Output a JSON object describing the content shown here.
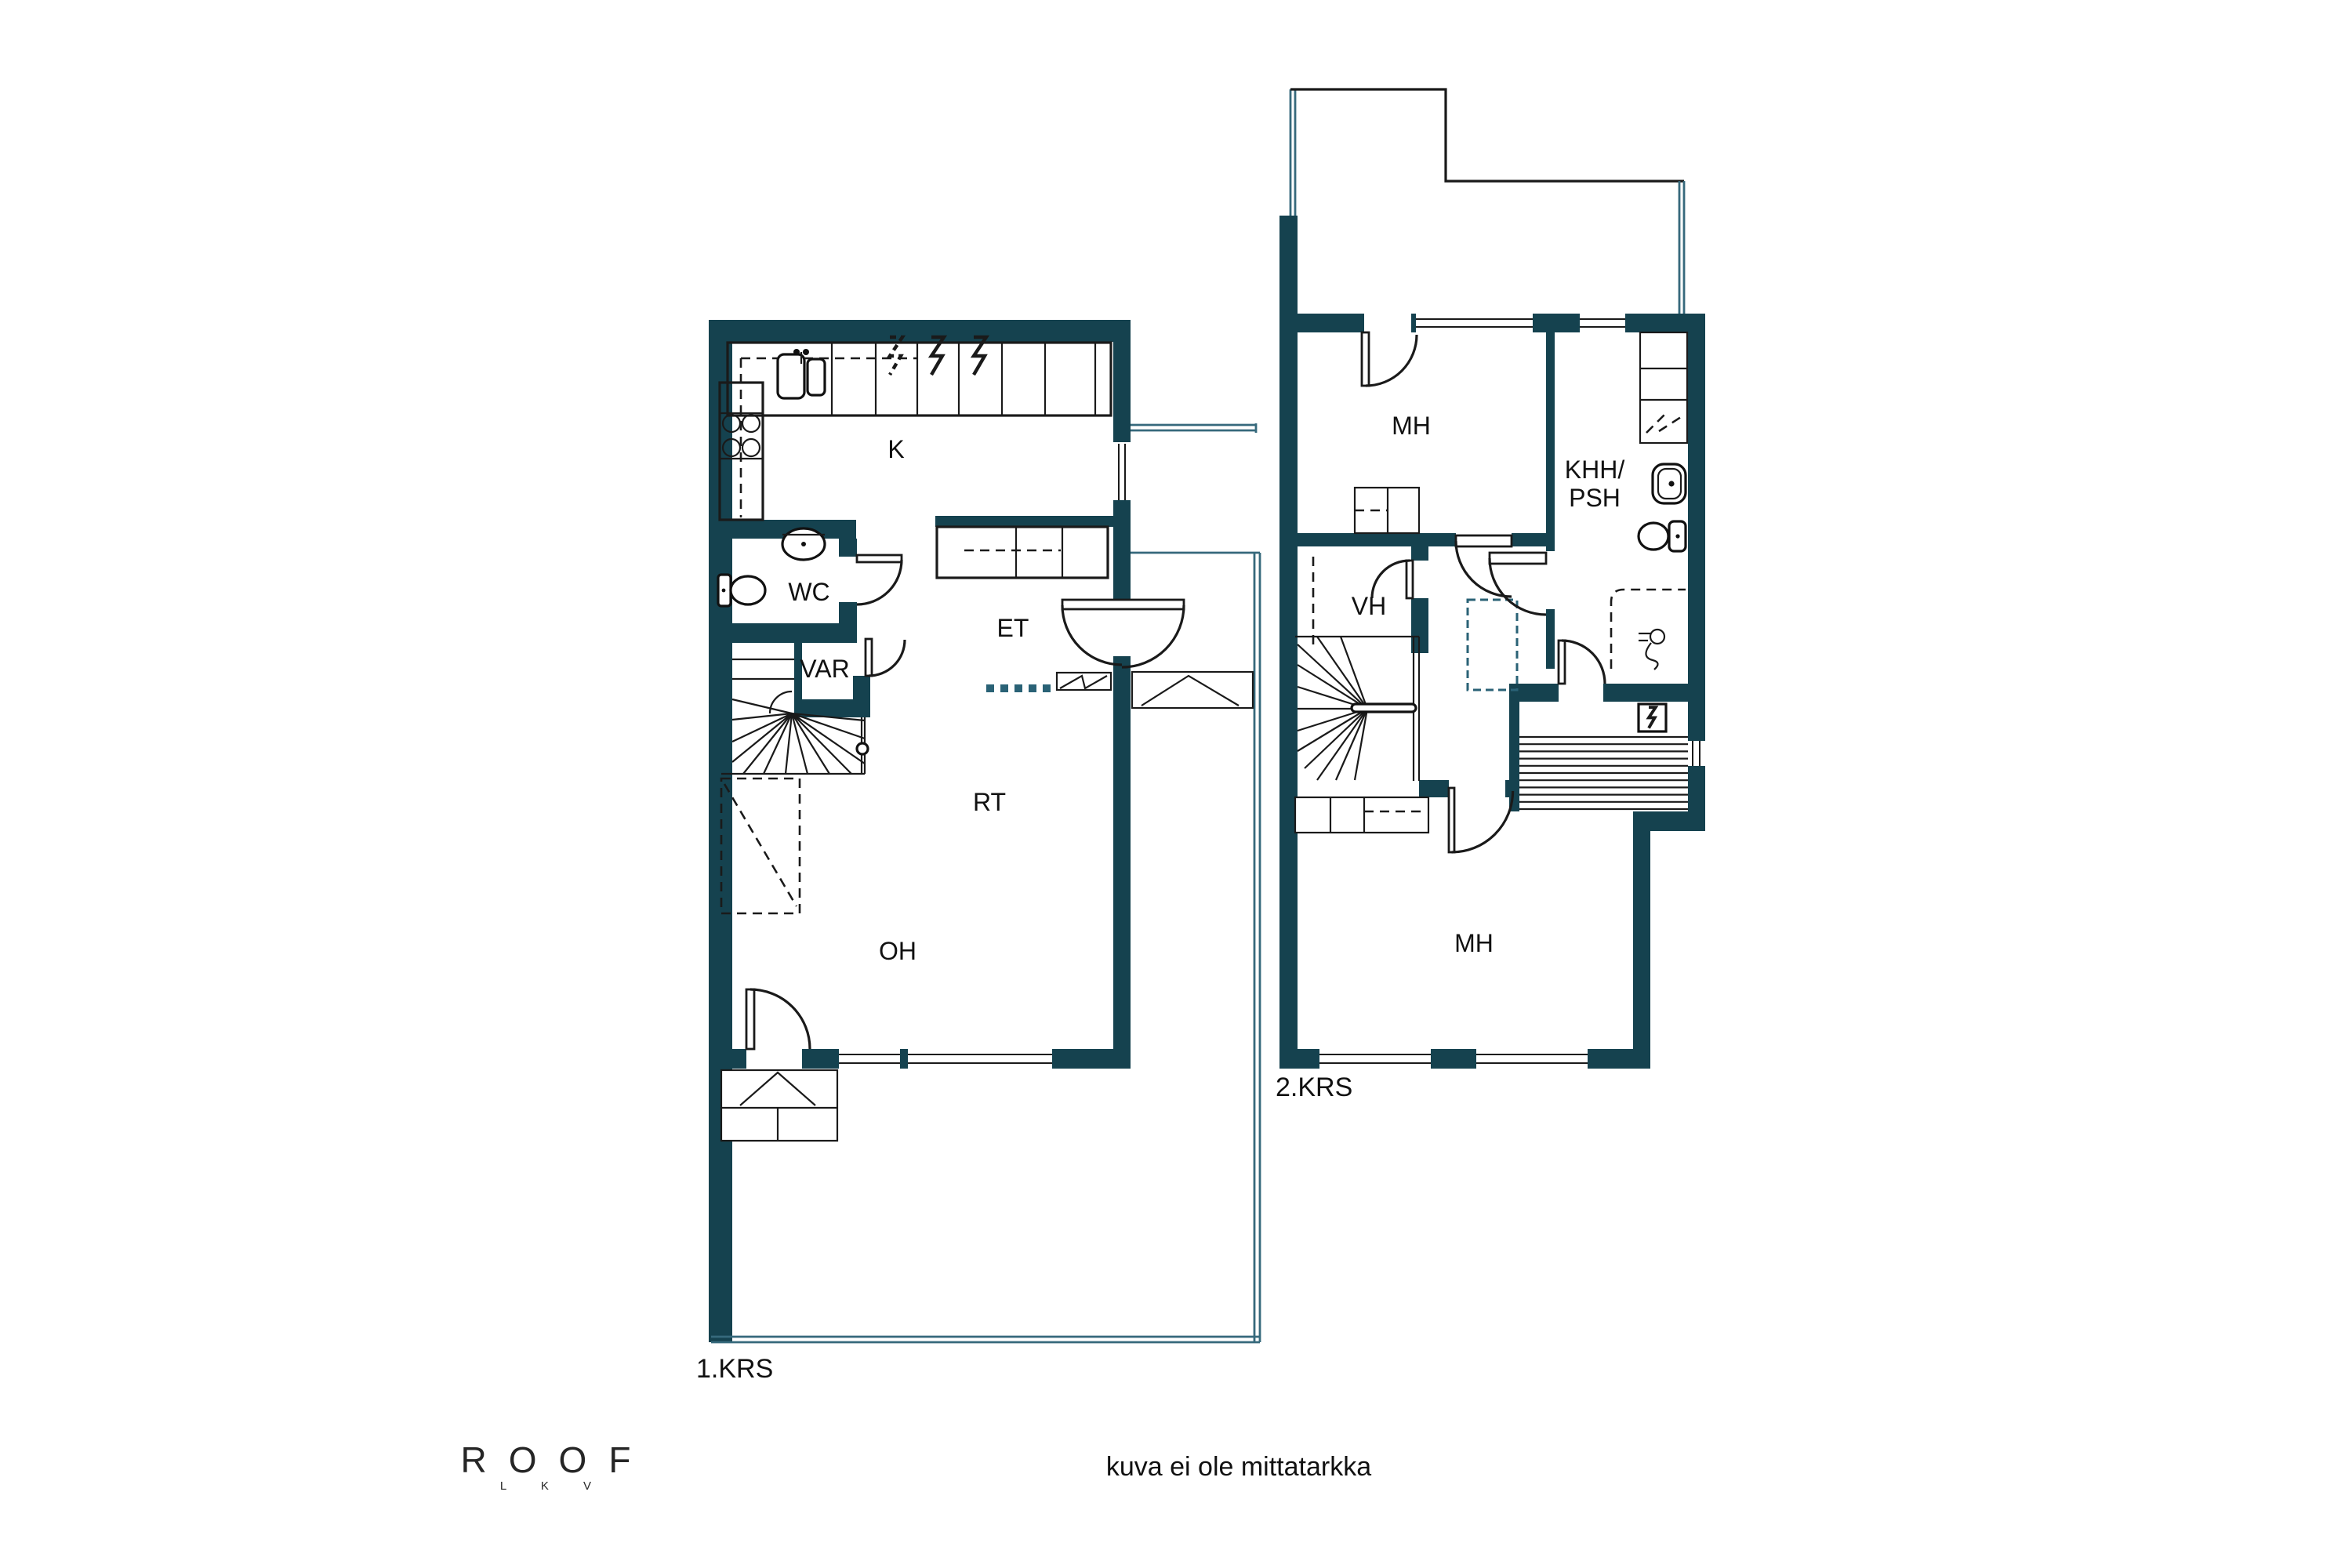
{
  "meta": {
    "floor1_label": "1.KRS",
    "floor2_label": "2.KRS",
    "disclaimer": "kuva ei ole mittatarkka"
  },
  "logo": {
    "name": "ROOF",
    "subtitle": "L K V"
  },
  "rooms_floor1": {
    "kitchen": "K",
    "toilet": "WC",
    "storage": "VAR",
    "entrance": "ET",
    "dining": "RT",
    "living": "OH"
  },
  "rooms_floor2": {
    "bedroom_top": "MH",
    "utility_line1": "KHH/",
    "utility_line2": "PSH",
    "closet": "VH",
    "bedroom_bottom": "MH"
  },
  "colors": {
    "wall": "#15424f",
    "line": "#1a1a1a",
    "thin_outline": "#36697c",
    "threshold_dash": "#2a6276",
    "background": "#ffffff"
  },
  "icons": {
    "stove": "four-burner-circles",
    "kitchen_sink": "double-basin-sink",
    "appliance": "lightning-bolt",
    "wc_sink": "oval-basin",
    "wc_toilet": "toilet-with-tank",
    "stairs": "winder-staircase",
    "sauna_benches": "horizontal-slats",
    "sauna_stove": "lightning-box",
    "shower": "dashed-enclosure-with-mixer",
    "washer_reserved": "dashed-marks"
  }
}
